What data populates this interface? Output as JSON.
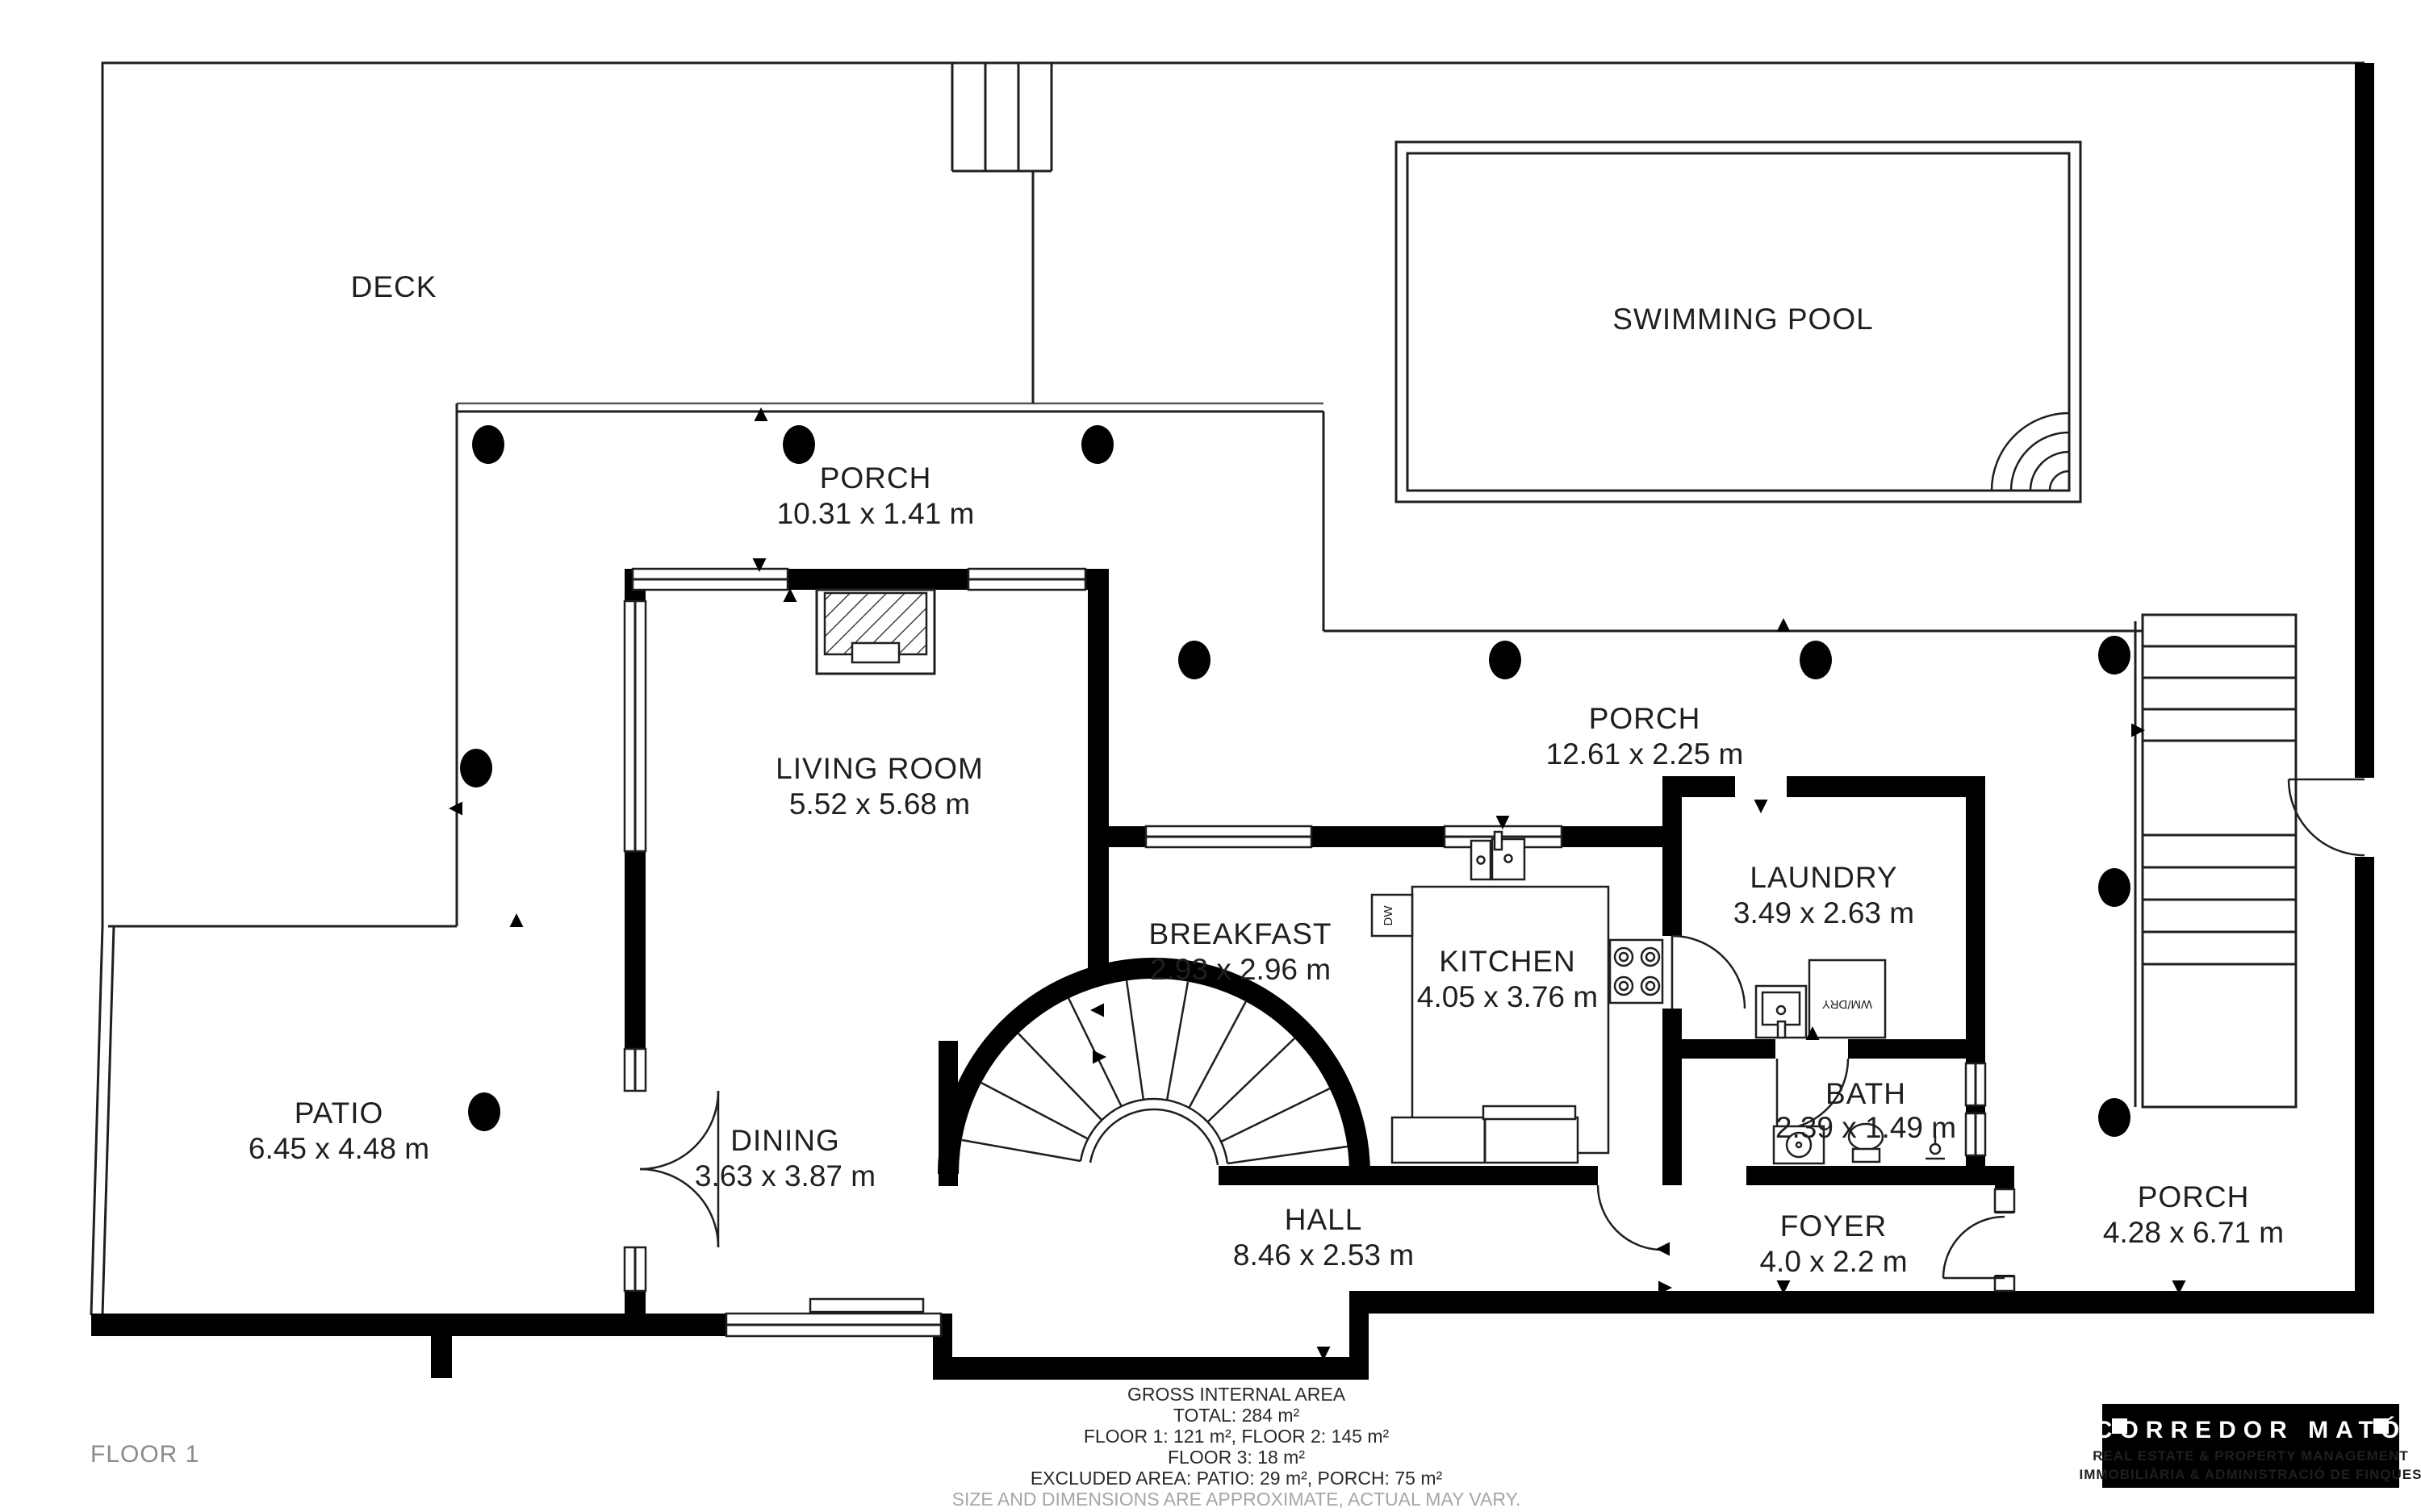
{
  "page": {
    "floor_label": "FLOOR 1",
    "background": "#ffffff",
    "wall_color": "#000000",
    "line_color": "#1f1f1f"
  },
  "rooms": {
    "deck": {
      "name": "DECK"
    },
    "pool": {
      "name": "SWIMMING POOL"
    },
    "porch_top": {
      "name": "PORCH",
      "dims": "10.31 x 1.41 m"
    },
    "porch_mid": {
      "name": "PORCH",
      "dims": "12.61 x 2.25 m"
    },
    "porch_right": {
      "name": "PORCH",
      "dims": "4.28 x 6.71 m"
    },
    "living": {
      "name": "LIVING ROOM",
      "dims": "5.52 x 5.68 m"
    },
    "breakfast": {
      "name": "BREAKFAST",
      "dims": "2.93 x 2.96 m"
    },
    "kitchen": {
      "name": "KITCHEN",
      "dims": "4.05 x 3.76 m"
    },
    "laundry": {
      "name": "LAUNDRY",
      "dims": "3.49 x 2.63 m"
    },
    "bath": {
      "name": "BATH",
      "dims": "2.39 x 1.49 m"
    },
    "patio": {
      "name": "PATIO",
      "dims": "6.45 x 4.48 m"
    },
    "dining": {
      "name": "DINING",
      "dims": "3.63 x 3.87 m"
    },
    "hall": {
      "name": "HALL",
      "dims": "8.46 x 2.53 m"
    },
    "foyer": {
      "name": "FOYER",
      "dims": "4.0 x 2.2 m"
    }
  },
  "fixtures": {
    "dishwasher": "DW",
    "washer_dryer": "WM/DRY"
  },
  "footer": {
    "line1": "GROSS INTERNAL AREA",
    "line2": "TOTAL: 284 m²",
    "line3": "FLOOR 1: 121 m², FLOOR 2: 145 m²",
    "line4": "FLOOR 3: 18 m²",
    "line5": "EXCLUDED AREA: PATIO: 29 m², PORCH: 75 m²",
    "disclaimer": "SIZE AND DIMENSIONS ARE APPROXIMATE, ACTUAL MAY VARY."
  },
  "logo": {
    "title": "CORREDOR MATÓ",
    "subtitle1": "REAL ESTATE & PROPERTY MANAGEMENT",
    "subtitle2": "IMMOBILIÀRIA & ADMINISTRACIÓ DE FINQUES",
    "background": "#000000",
    "accent": "#d2232a"
  }
}
